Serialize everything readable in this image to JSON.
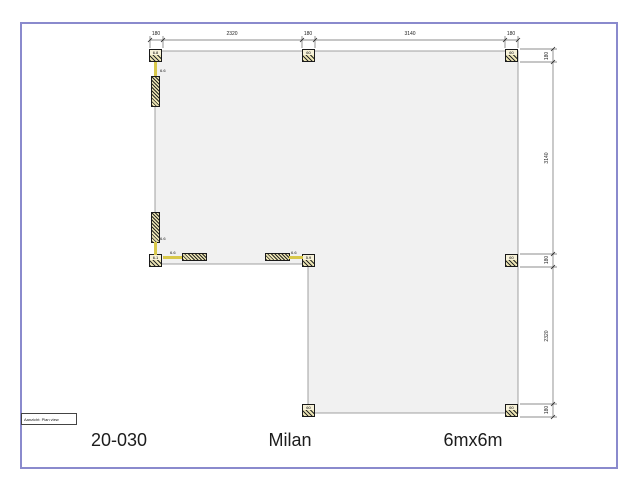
{
  "page": {
    "footer": {
      "project_code": "20-030",
      "model_name": "Milan",
      "size_label": "6mx6m"
    },
    "view_label": "Aanzicht:  Plan view"
  },
  "dimensions": {
    "top": [
      "180",
      "2320",
      "180",
      "3140",
      "180"
    ],
    "right": [
      "180",
      "3140",
      "180",
      "2320",
      "180"
    ],
    "total_width_mm": 6000,
    "total_depth_mm": 6000
  },
  "plan": {
    "shape": "L-shaped plan, upper rectangle full width, lower-right square, notch at lower-left",
    "posts": [
      {
        "id": "top-left",
        "label": "6.8"
      },
      {
        "id": "top-middle",
        "label": "60"
      },
      {
        "id": "top-right",
        "label": "60"
      },
      {
        "id": "left-bottom",
        "label": "6.1"
      },
      {
        "id": "inner-corner",
        "label": "5.9"
      },
      {
        "id": "right-middle",
        "label": "60"
      },
      {
        "id": "bottom-middle",
        "label": "60"
      },
      {
        "id": "bottom-right",
        "label": "60"
      }
    ],
    "connector_labels": [
      "6.6",
      "6.6",
      "6.6",
      "6.6"
    ]
  },
  "colors": {
    "frame_border": "#8a8acd",
    "plan_fill": "#f1f1f1",
    "plan_stroke": "#a0a0a0",
    "dimension_line": "#666666",
    "post_fill": "#ece5b4",
    "connector": "#d8c84a"
  }
}
